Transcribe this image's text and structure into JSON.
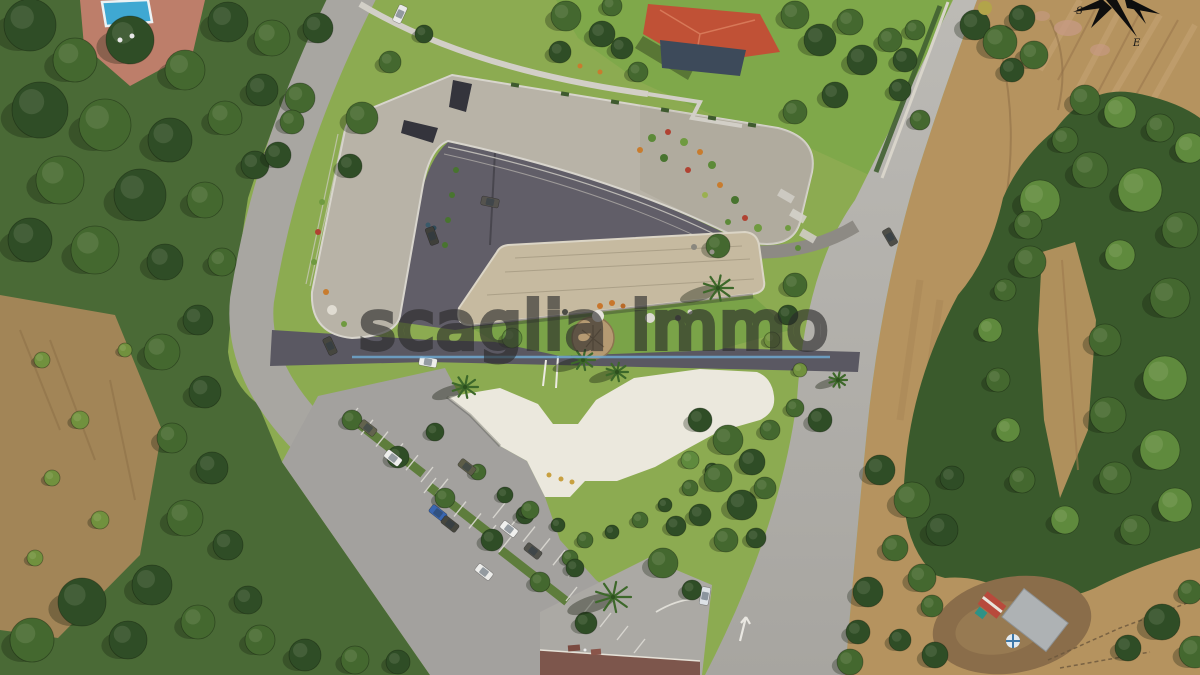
{
  "watermark": {
    "text": "scaglia immo",
    "text_stroke": "rgba(42,42,42,0.62)",
    "line_color": "#6ea7cf"
  },
  "compass": {
    "s_label": "S",
    "e_label": "E"
  },
  "palette": {
    "site_lawn": "#8cab51",
    "villa_lawn": "#7fa84a",
    "wild_green": "#4a6a36",
    "dry_tan": "#b5935f",
    "dry_brown": "#a28557",
    "road": "#a8a6a1",
    "road_light": "#bcbab5",
    "dark_pavement": "#615e68",
    "walkway": "#5a5862",
    "roof_upper": "#b8b3a7",
    "roof_lower": "#c6baa0",
    "plaza_white": "#ebe8dd",
    "pool_blue": "#3fa8d2",
    "terrace_pink": "#bd7e6a",
    "villa_roof": "#c05136",
    "farm_roof": "#aeb2b4",
    "tree_dark": "#2f4d26",
    "tree_mid": "#44682f",
    "tree_light": "#5f8a3d",
    "tree_olive": "#71913e",
    "palm": "#3d682a"
  },
  "scene": {
    "trees": [
      [
        30,
        25,
        26,
        "d"
      ],
      [
        75,
        60,
        22,
        "m"
      ],
      [
        130,
        40,
        24,
        "d"
      ],
      [
        185,
        70,
        20,
        "m"
      ],
      [
        228,
        22,
        20,
        "d"
      ],
      [
        272,
        38,
        18,
        "m"
      ],
      [
        318,
        28,
        15,
        "d"
      ],
      [
        40,
        110,
        28,
        "d"
      ],
      [
        105,
        125,
        26,
        "m"
      ],
      [
        170,
        140,
        22,
        "d"
      ],
      [
        225,
        118,
        17,
        "m"
      ],
      [
        262,
        90,
        16,
        "d"
      ],
      [
        300,
        98,
        15,
        "m"
      ],
      [
        60,
        180,
        24,
        "m"
      ],
      [
        140,
        195,
        26,
        "d"
      ],
      [
        205,
        200,
        18,
        "m"
      ],
      [
        255,
        165,
        14,
        "d"
      ],
      [
        278,
        155,
        13,
        "d"
      ],
      [
        292,
        122,
        12,
        "m"
      ],
      [
        30,
        240,
        22,
        "d"
      ],
      [
        95,
        250,
        24,
        "m"
      ],
      [
        165,
        262,
        18,
        "d"
      ],
      [
        222,
        262,
        14,
        "m"
      ],
      [
        198,
        320,
        15,
        "d"
      ],
      [
        162,
        352,
        18,
        "m"
      ],
      [
        205,
        392,
        16,
        "d"
      ],
      [
        172,
        438,
        15,
        "m"
      ],
      [
        212,
        468,
        16,
        "d"
      ],
      [
        185,
        518,
        18,
        "m"
      ],
      [
        228,
        545,
        15,
        "d"
      ],
      [
        152,
        585,
        20,
        "d"
      ],
      [
        82,
        602,
        24,
        "d"
      ],
      [
        32,
        640,
        22,
        "m"
      ],
      [
        128,
        640,
        19,
        "d"
      ],
      [
        198,
        622,
        17,
        "m"
      ],
      [
        248,
        600,
        14,
        "d"
      ],
      [
        260,
        640,
        15,
        "m"
      ],
      [
        305,
        655,
        16,
        "d"
      ],
      [
        355,
        660,
        14,
        "m"
      ],
      [
        398,
        662,
        12,
        "d"
      ],
      [
        42,
        360,
        8,
        "o"
      ],
      [
        80,
        420,
        9,
        "o"
      ],
      [
        52,
        478,
        8,
        "o"
      ],
      [
        100,
        520,
        9,
        "o"
      ],
      [
        35,
        558,
        8,
        "o"
      ],
      [
        125,
        350,
        7,
        "o"
      ],
      [
        566,
        16,
        15,
        "m"
      ],
      [
        602,
        34,
        13,
        "d"
      ],
      [
        560,
        52,
        11,
        "d"
      ],
      [
        612,
        6,
        10,
        "m"
      ],
      [
        638,
        72,
        10,
        "m"
      ],
      [
        622,
        48,
        11,
        "d"
      ],
      [
        795,
        15,
        14,
        "m"
      ],
      [
        820,
        40,
        16,
        "d"
      ],
      [
        850,
        22,
        13,
        "m"
      ],
      [
        862,
        60,
        15,
        "d"
      ],
      [
        890,
        40,
        12,
        "m"
      ],
      [
        835,
        95,
        13,
        "d"
      ],
      [
        795,
        112,
        12,
        "m"
      ],
      [
        900,
        90,
        11,
        "d"
      ],
      [
        920,
        120,
        10,
        "m"
      ],
      [
        905,
        60,
        12,
        "d"
      ],
      [
        915,
        30,
        10,
        "m"
      ],
      [
        975,
        25,
        15,
        "d"
      ],
      [
        1000,
        42,
        17,
        "m"
      ],
      [
        1022,
        18,
        13,
        "d"
      ],
      [
        1034,
        55,
        14,
        "m"
      ],
      [
        1012,
        70,
        12,
        "d"
      ],
      [
        362,
        118,
        16,
        "m"
      ],
      [
        350,
        166,
        12,
        "d"
      ],
      [
        390,
        62,
        11,
        "m"
      ],
      [
        424,
        34,
        9,
        "d"
      ],
      [
        352,
        420,
        10,
        "m"
      ],
      [
        398,
        457,
        11,
        "d"
      ],
      [
        445,
        498,
        10,
        "m"
      ],
      [
        492,
        540,
        11,
        "d"
      ],
      [
        540,
        582,
        10,
        "m"
      ],
      [
        586,
        623,
        11,
        "d"
      ],
      [
        435,
        432,
        9,
        "d"
      ],
      [
        478,
        472,
        8,
        "m"
      ],
      [
        525,
        515,
        9,
        "d"
      ],
      [
        570,
        558,
        8,
        "m"
      ],
      [
        512,
        338,
        10,
        "l"
      ],
      [
        718,
        246,
        12,
        "m"
      ],
      [
        505,
        495,
        8,
        "d"
      ],
      [
        530,
        510,
        9,
        "m"
      ],
      [
        558,
        525,
        7,
        "d"
      ],
      [
        585,
        540,
        8,
        "m"
      ],
      [
        612,
        532,
        7,
        "d"
      ],
      [
        640,
        520,
        8,
        "m"
      ],
      [
        665,
        505,
        7,
        "d"
      ],
      [
        690,
        488,
        8,
        "m"
      ],
      [
        712,
        470,
        7,
        "d"
      ],
      [
        700,
        420,
        12,
        "d"
      ],
      [
        728,
        440,
        15,
        "m"
      ],
      [
        752,
        462,
        13,
        "d"
      ],
      [
        718,
        478,
        14,
        "m"
      ],
      [
        742,
        505,
        15,
        "d"
      ],
      [
        765,
        488,
        11,
        "m"
      ],
      [
        700,
        515,
        11,
        "d"
      ],
      [
        726,
        540,
        12,
        "m"
      ],
      [
        756,
        538,
        10,
        "d"
      ],
      [
        770,
        430,
        10,
        "m"
      ],
      [
        690,
        460,
        9,
        "l"
      ],
      [
        663,
        563,
        15,
        "m"
      ],
      [
        676,
        526,
        10,
        "d"
      ],
      [
        692,
        590,
        10,
        "d"
      ],
      [
        575,
        568,
        9,
        "d"
      ],
      [
        795,
        285,
        12,
        "m"
      ],
      [
        788,
        315,
        10,
        "d"
      ],
      [
        820,
        420,
        12,
        "d"
      ],
      [
        795,
        408,
        9,
        "m"
      ],
      [
        772,
        340,
        8,
        "o"
      ],
      [
        800,
        370,
        7,
        "o"
      ],
      [
        880,
        470,
        15,
        "d"
      ],
      [
        912,
        500,
        18,
        "m"
      ],
      [
        942,
        530,
        16,
        "d"
      ],
      [
        895,
        548,
        13,
        "m"
      ],
      [
        868,
        592,
        15,
        "d"
      ],
      [
        922,
        578,
        14,
        "m"
      ],
      [
        952,
        478,
        12,
        "d"
      ],
      [
        858,
        632,
        12,
        "d"
      ],
      [
        850,
        662,
        13,
        "m"
      ],
      [
        900,
        640,
        11,
        "d"
      ],
      [
        935,
        655,
        13,
        "d"
      ],
      [
        932,
        606,
        11,
        "m"
      ],
      [
        1040,
        200,
        20,
        "l"
      ],
      [
        1090,
        170,
        18,
        "m"
      ],
      [
        1140,
        190,
        22,
        "l"
      ],
      [
        1180,
        230,
        18,
        "m"
      ],
      [
        1030,
        262,
        16,
        "m"
      ],
      [
        1120,
        255,
        15,
        "l"
      ],
      [
        1170,
        298,
        20,
        "m"
      ],
      [
        1105,
        340,
        16,
        "m"
      ],
      [
        1165,
        378,
        22,
        "l"
      ],
      [
        1108,
        415,
        18,
        "m"
      ],
      [
        1160,
        450,
        20,
        "l"
      ],
      [
        1115,
        478,
        16,
        "m"
      ],
      [
        1175,
        505,
        17,
        "l"
      ],
      [
        1135,
        530,
        15,
        "m"
      ],
      [
        1065,
        520,
        14,
        "l"
      ],
      [
        1022,
        480,
        13,
        "m"
      ],
      [
        1008,
        430,
        12,
        "l"
      ],
      [
        998,
        380,
        12,
        "m"
      ],
      [
        990,
        330,
        12,
        "l"
      ],
      [
        1005,
        290,
        11,
        "m"
      ],
      [
        1028,
        225,
        14,
        "m"
      ],
      [
        1085,
        100,
        15,
        "m"
      ],
      [
        1120,
        112,
        16,
        "l"
      ],
      [
        1160,
        128,
        14,
        "m"
      ],
      [
        1190,
        148,
        15,
        "l"
      ],
      [
        1065,
        140,
        13,
        "m"
      ],
      [
        1162,
        622,
        18,
        "d"
      ],
      [
        1195,
        652,
        16,
        "m"
      ],
      [
        1128,
        648,
        13,
        "d"
      ],
      [
        1190,
        592,
        12,
        "m"
      ]
    ],
    "palms": [
      [
        718,
        288,
        15
      ],
      [
        583,
        360,
        12
      ],
      [
        617,
        372,
        11
      ],
      [
        465,
        387,
        13
      ],
      [
        613,
        597,
        18
      ],
      [
        838,
        380,
        9
      ]
    ],
    "cars": [
      [
        400,
        14,
        115,
        "#e9e9e7"
      ],
      [
        490,
        202,
        12,
        "#55534e"
      ],
      [
        432,
        236,
        70,
        "#3f3f3a"
      ],
      [
        428,
        362,
        10,
        "#ededeb"
      ],
      [
        330,
        346,
        65,
        "#46463f"
      ],
      [
        368,
        428,
        38,
        "#63634e"
      ],
      [
        393,
        458,
        38,
        "#eeeeec"
      ],
      [
        467,
        467,
        38,
        "#5d5d48"
      ],
      [
        438,
        513,
        38,
        "#3a66b0"
      ],
      [
        450,
        524,
        38,
        "#46463e"
      ],
      [
        509,
        529,
        38,
        "#f0f0ee"
      ],
      [
        533,
        551,
        38,
        "#52524c"
      ],
      [
        484,
        572,
        38,
        "#ececea"
      ],
      [
        705,
        596,
        100,
        "#dde2e6"
      ],
      [
        890,
        237,
        60,
        "#4e4e48"
      ]
    ],
    "dots": [
      [
        600,
        306,
        3,
        "#c8762c"
      ],
      [
        612,
        303,
        3,
        "#c8762c"
      ],
      [
        623,
        306,
        2.5,
        "#b86a28"
      ],
      [
        598,
        316,
        6,
        "#e6e3dc"
      ],
      [
        650,
        318,
        5,
        "#dcd9d2"
      ],
      [
        565,
        312,
        3,
        "#4c4c46"
      ],
      [
        678,
        318,
        3,
        "#52524c"
      ],
      [
        690,
        312,
        2.5,
        "#d8d5ce"
      ],
      [
        652,
        138,
        4,
        "#5c8a38"
      ],
      [
        668,
        132,
        3,
        "#b04232"
      ],
      [
        684,
        142,
        4,
        "#6f9a40"
      ],
      [
        700,
        152,
        3,
        "#c87c2e"
      ],
      [
        664,
        158,
        4,
        "#48742f"
      ],
      [
        688,
        170,
        3,
        "#b04232"
      ],
      [
        712,
        165,
        4,
        "#5c8a38"
      ],
      [
        720,
        185,
        3,
        "#c87c2e"
      ],
      [
        735,
        200,
        4,
        "#48742f"
      ],
      [
        745,
        218,
        3,
        "#b04232"
      ],
      [
        758,
        228,
        4,
        "#6f9a40"
      ],
      [
        640,
        150,
        3,
        "#c87c2e"
      ],
      [
        705,
        195,
        3,
        "#9ab050"
      ],
      [
        728,
        222,
        3,
        "#5c8a38"
      ],
      [
        788,
        228,
        3,
        "#6f9a40"
      ],
      [
        798,
        248,
        3,
        "#5c8a38"
      ],
      [
        322,
        202,
        3,
        "#6f9a40"
      ],
      [
        318,
        232,
        3,
        "#b04232"
      ],
      [
        314,
        262,
        3,
        "#6f9a40"
      ],
      [
        326,
        292,
        3,
        "#c87c2e"
      ],
      [
        332,
        310,
        5,
        "#e0dcd2"
      ],
      [
        344,
        324,
        3,
        "#6f9a40"
      ],
      [
        456,
        170,
        3,
        "#48742f"
      ],
      [
        452,
        195,
        3,
        "#48742f"
      ],
      [
        448,
        220,
        3,
        "#48742f"
      ],
      [
        445,
        245,
        3,
        "#48742f"
      ],
      [
        549,
        475,
        2.5,
        "#c8a040"
      ],
      [
        561,
        479,
        2.5,
        "#c8a040"
      ],
      [
        572,
        482,
        2.5,
        "#c8a040"
      ],
      [
        428,
        225,
        2.5,
        "#3a5a6a"
      ],
      [
        434,
        228,
        2.5,
        "#2f4a58"
      ],
      [
        580,
        66,
        2.5,
        "#c87c2e"
      ],
      [
        600,
        72,
        2.5,
        "#c87c2e"
      ],
      [
        694,
        247,
        3,
        "#8a877e"
      ],
      [
        712,
        252,
        2.5,
        "#97948b"
      ],
      [
        120,
        40,
        2.5,
        "#e8e8e8"
      ],
      [
        132,
        36,
        2.5,
        "#e8e8e8"
      ],
      [
        585,
        650,
        1.5,
        "#ededed"
      ],
      [
        985,
        8,
        7,
        "#b2a44a"
      ]
    ],
    "planters": [
      [
        515,
        85
      ],
      [
        565,
        94
      ],
      [
        615,
        102
      ],
      [
        665,
        110
      ],
      [
        712,
        118
      ],
      [
        752,
        125
      ]
    ],
    "medians": [
      [
        390,
        448
      ],
      [
        462,
        512
      ],
      [
        534,
        576
      ]
    ],
    "stall_rows": [
      {
        "x": 358,
        "y": 408,
        "dx": 15,
        "dy": 11.8,
        "n": 7,
        "px": -12,
        "py": 15
      },
      {
        "x": 436,
        "y": 478,
        "dx": 15,
        "dy": 11.8,
        "n": 6,
        "px": -12,
        "py": 15
      },
      {
        "x": 505,
        "y": 503,
        "dx": 15,
        "dy": 11.8,
        "n": 6,
        "px": -12,
        "py": 15
      },
      {
        "x": 566,
        "y": 601,
        "dx": 17,
        "dy": 13,
        "n": 5,
        "px": 11,
        "py": -14
      }
    ]
  }
}
